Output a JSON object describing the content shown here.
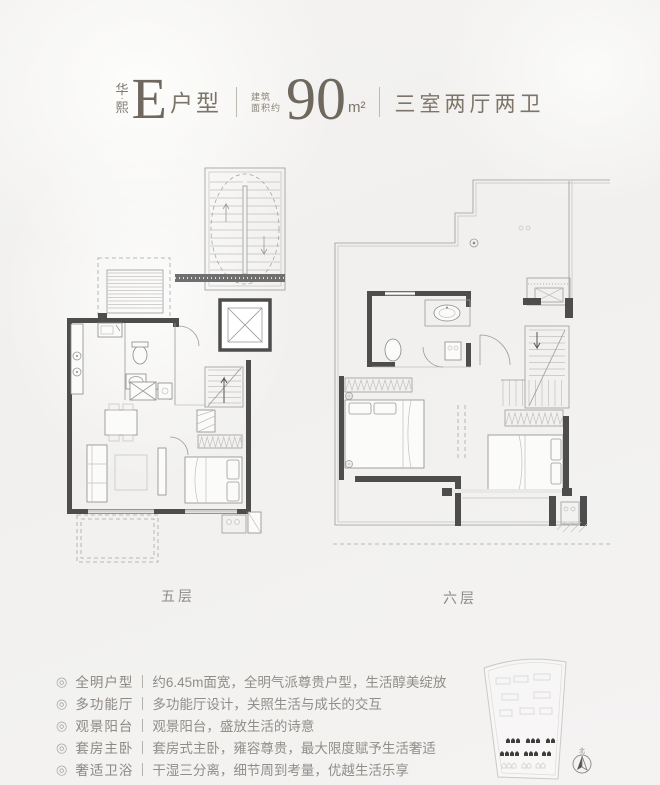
{
  "colors": {
    "accent": "#7c7568",
    "ink_dark": "#6f685e",
    "wall": "#4d4d4d",
    "plan_line": "#9a9a9a",
    "body_text": "#908d88",
    "background": "#f2f1ef"
  },
  "header": {
    "brand_line1": "华",
    "brand_dot": "·",
    "brand_line2": "熙",
    "unit_letter": "E",
    "unit_suffix": "户型",
    "area_label_line1": "建筑",
    "area_label_line2": "面积约",
    "area_value": "90",
    "area_unit": "m²",
    "layout_summary": "三室两厅两卫"
  },
  "plans": {
    "left_label": "五层",
    "right_label": "六层"
  },
  "features_bullet": "◎",
  "features": [
    {
      "title": "全明户型",
      "desc": "约6.45m面宽，全明气派尊贵户型，生活醇美绽放"
    },
    {
      "title": "多功能厅",
      "desc": "多功能厅设计，关照生活与成长的交互"
    },
    {
      "title": "观景阳台",
      "desc": "观景阳台，盛放生活的诗意"
    },
    {
      "title": "套房主卧",
      "desc": "套房式主卧，雍容尊贵，最大限度赋予生活奢适"
    },
    {
      "title": "奢适卫浴",
      "desc": "干湿三分离，细节周到考量，优越生活乐享"
    }
  ],
  "site_map": {
    "compass_label": "北"
  }
}
